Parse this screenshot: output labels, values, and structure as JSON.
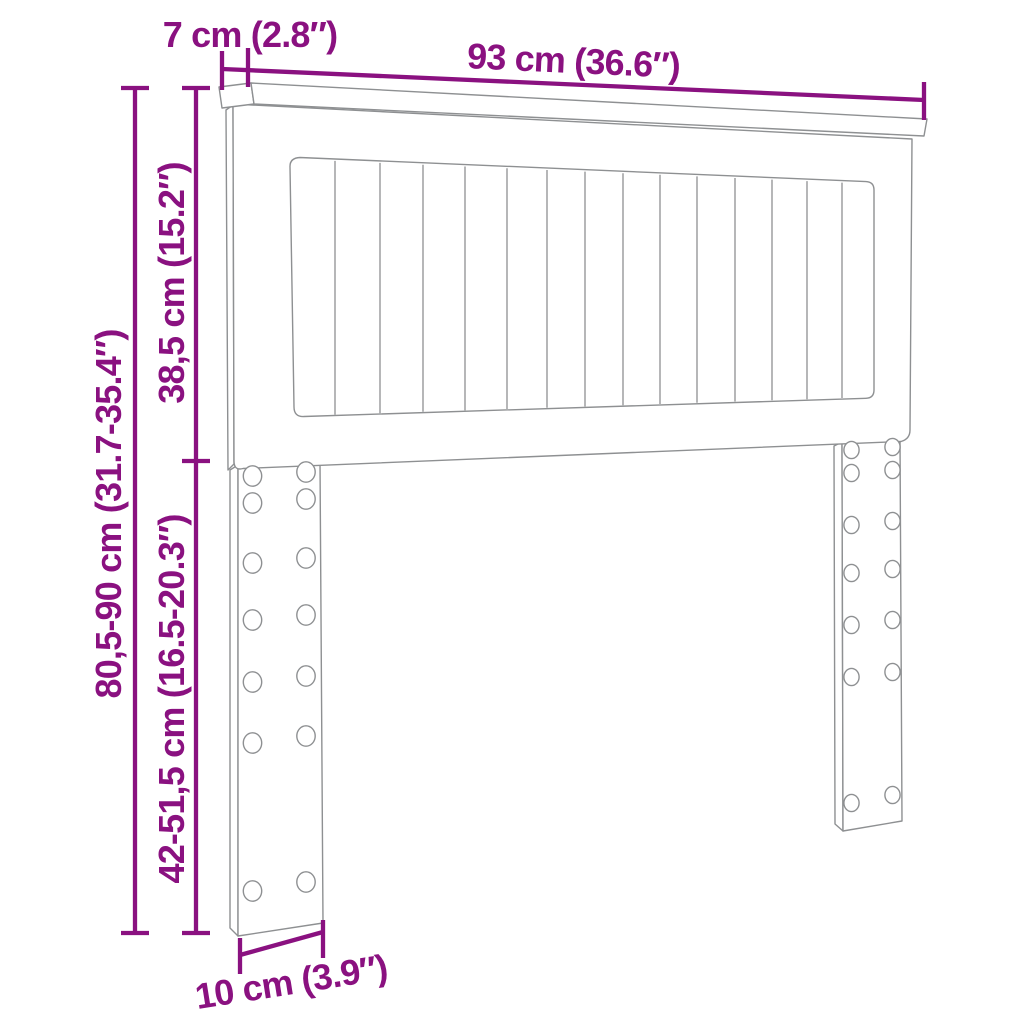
{
  "colors": {
    "dimension-color": "#8A1180",
    "line-color": "#8E9092",
    "background": "#FFFFFF"
  },
  "dimensions": {
    "cap_depth": {
      "label": "7 cm (2.8″)"
    },
    "width": {
      "label": "93 cm (36.6″)"
    },
    "upper_height": {
      "label": "38,5 cm (15.2″)"
    },
    "total_height": {
      "label": "80,5-90 cm (31.7-35.4″)"
    },
    "leg_height": {
      "label": "42-51,5 cm (16.5-20.3″)"
    },
    "leg_width": {
      "label": "10 cm (3.9″)"
    }
  }
}
